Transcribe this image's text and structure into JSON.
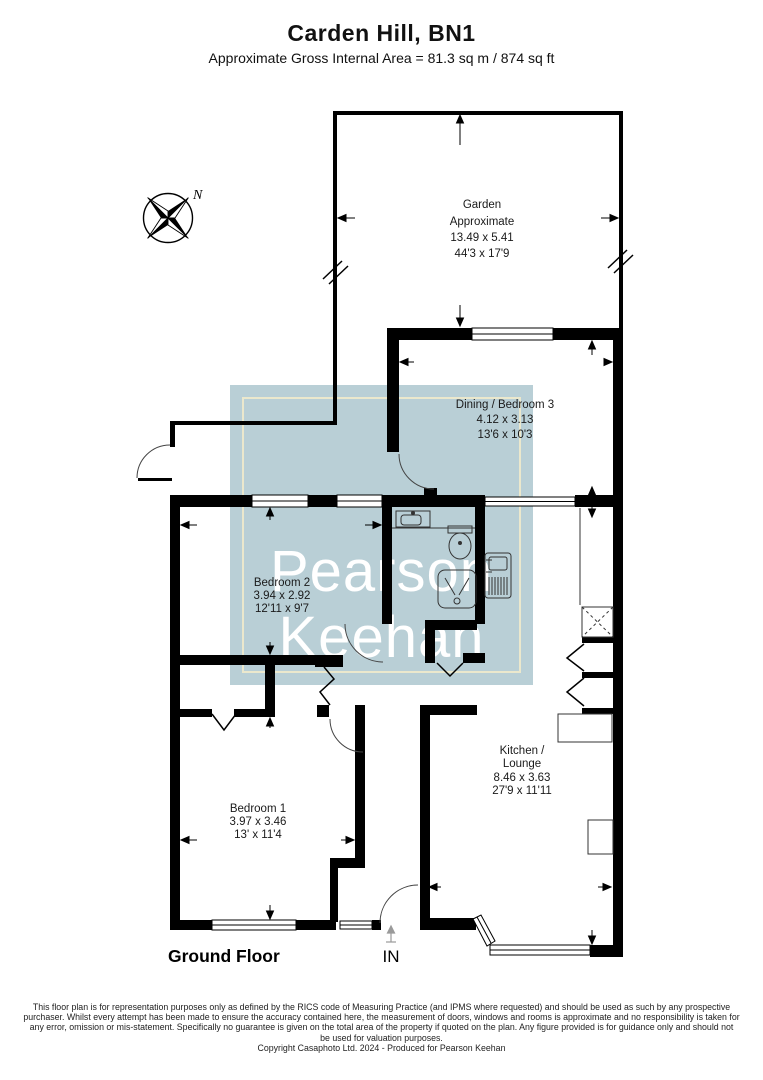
{
  "header": {
    "title": "Carden Hill, BN1",
    "subtitle": "Approximate Gross Internal Area = 81.3 sq m / 874 sq ft"
  },
  "compass": {
    "north": "N"
  },
  "rooms": {
    "garden": {
      "name": "Garden",
      "qualifier": "Approximate",
      "metric": "13.49 x 5.41",
      "imperial": "44'3 x 17'9"
    },
    "dining_bedroom3": {
      "name": "Dining / Bedroom 3",
      "metric": "4.12 x 3.13",
      "imperial": "13'6 x 10'3"
    },
    "bedroom2": {
      "name": "Bedroom 2",
      "metric": "3.94 x 2.92",
      "imperial": "12'11 x 9'7"
    },
    "kitchen_lounge": {
      "name": "Kitchen /",
      "name2": "Lounge",
      "metric": "8.46 x 3.63",
      "imperial": "27'9 x 11'11"
    },
    "bedroom1": {
      "name": "Bedroom 1",
      "metric": "3.97 x 3.46",
      "imperial": "13' x 11'4"
    }
  },
  "plan": {
    "floor_label": "Ground Floor",
    "entrance_label": "IN"
  },
  "watermark": {
    "line1": "Pearson",
    "line2": "Keehan",
    "square_color": "#b9cfd6",
    "inner_border_color": "#ebe8cd",
    "text_color": "#ffffff"
  },
  "footer": {
    "lines": [
      "This floor plan is for representation purposes only as defined by the RICS code of Measuring Practice (and IPMS where requested) and should be used as such by any prospective",
      "purchaser. Whilst every attempt has been made to ensure the accuracy contained here, the measurement of doors, windows and rooms is approximate and no responsibility is taken for",
      "any error, omission or mis-statement. Specifically no guarantee is given on the total area of the property if quoted on the plan. Any figure provided is for guidance only and should not",
      "be used for valuation purposes."
    ],
    "copyright": "Copyright Casaphoto Ltd. 2024 - Produced for Pearson Keehan"
  }
}
